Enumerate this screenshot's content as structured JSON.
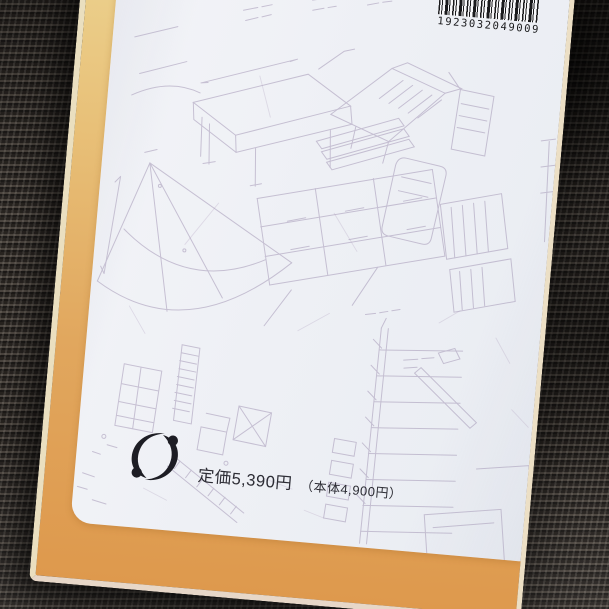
{
  "photo": {
    "description": "Back cover of a book with an orange border and faint architectural line drawings, lying on dark carpet",
    "barcode": {
      "number": "1923032049009"
    },
    "price": {
      "main": "定価5,390円",
      "sub": "（本体4,900円）"
    },
    "logo": {
      "name": "publisher-swirl-mark"
    },
    "colors": {
      "cover_border_top": "#ecd28f",
      "cover_border_bottom": "#de994d",
      "paper": "#eef0f5",
      "carpet": "#3a3531",
      "drawing_lines": "#9d8fb0",
      "barcode_ink": "#1a1a1c",
      "price_text": "#2c2c34"
    }
  }
}
